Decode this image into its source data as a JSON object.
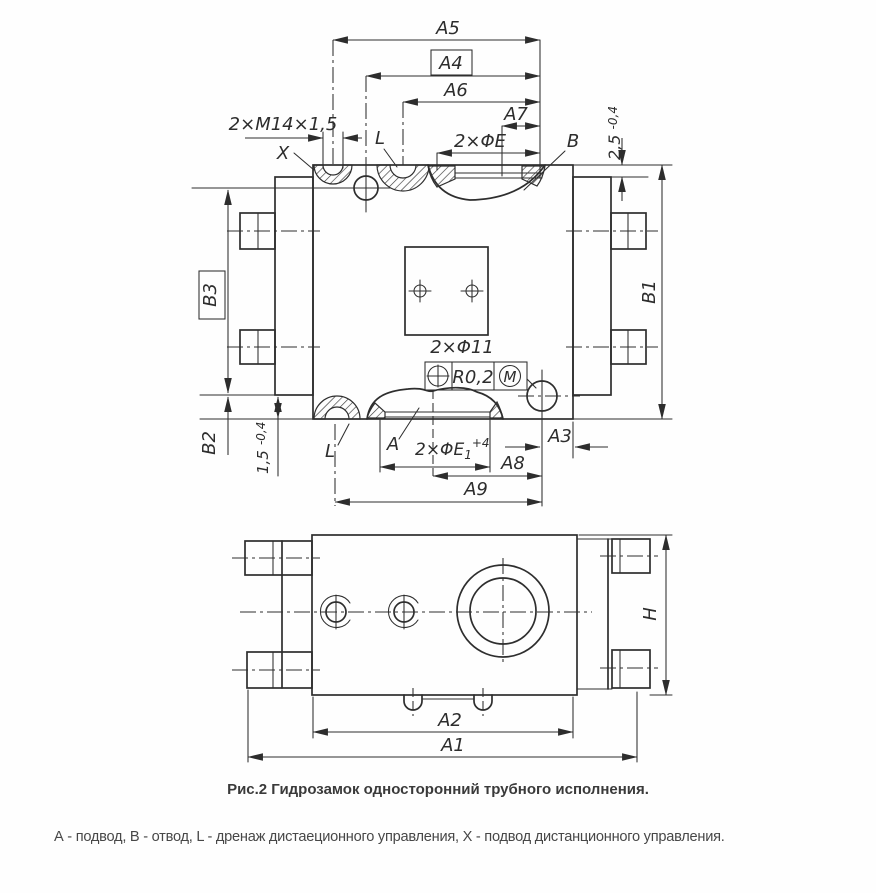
{
  "colors": {
    "ink": "#2e2e2e",
    "paper": "#fefefe",
    "text": "#3a3a3a"
  },
  "caption": "Рис.2 Гидрозамок односторонний трубного исполнения.",
  "legend": "А - подвод, В - отвод, L - дренаж дистаеционного управления, X - подвод дистанционного управления.",
  "labels": {
    "a5": "A5",
    "a4": "A4",
    "a6": "A6",
    "a7": "A7",
    "thread": "2×M14×1,5",
    "port_x": "X",
    "port_l_top": "L",
    "dia_e": "2×ΦE",
    "port_b": "B",
    "step_top": "2,5",
    "step_top_tol": "-0,4",
    "b1": "B1",
    "b3": "B3",
    "b2": "B2",
    "step_bottom": "1,5",
    "step_bottom_tol": "-0,4",
    "port_l_bottom": "L",
    "port_a": "A",
    "dia_e1": "2×ΦE",
    "dia_e1_sub": "1",
    "dia_e1_tol": "+4",
    "dia_11": "2×Φ11",
    "tol_value": "R0,2",
    "tol_mod": "M",
    "a3": "A3",
    "a8": "A8",
    "a9": "A9",
    "a2": "A2",
    "a1": "A1",
    "h": "H"
  }
}
